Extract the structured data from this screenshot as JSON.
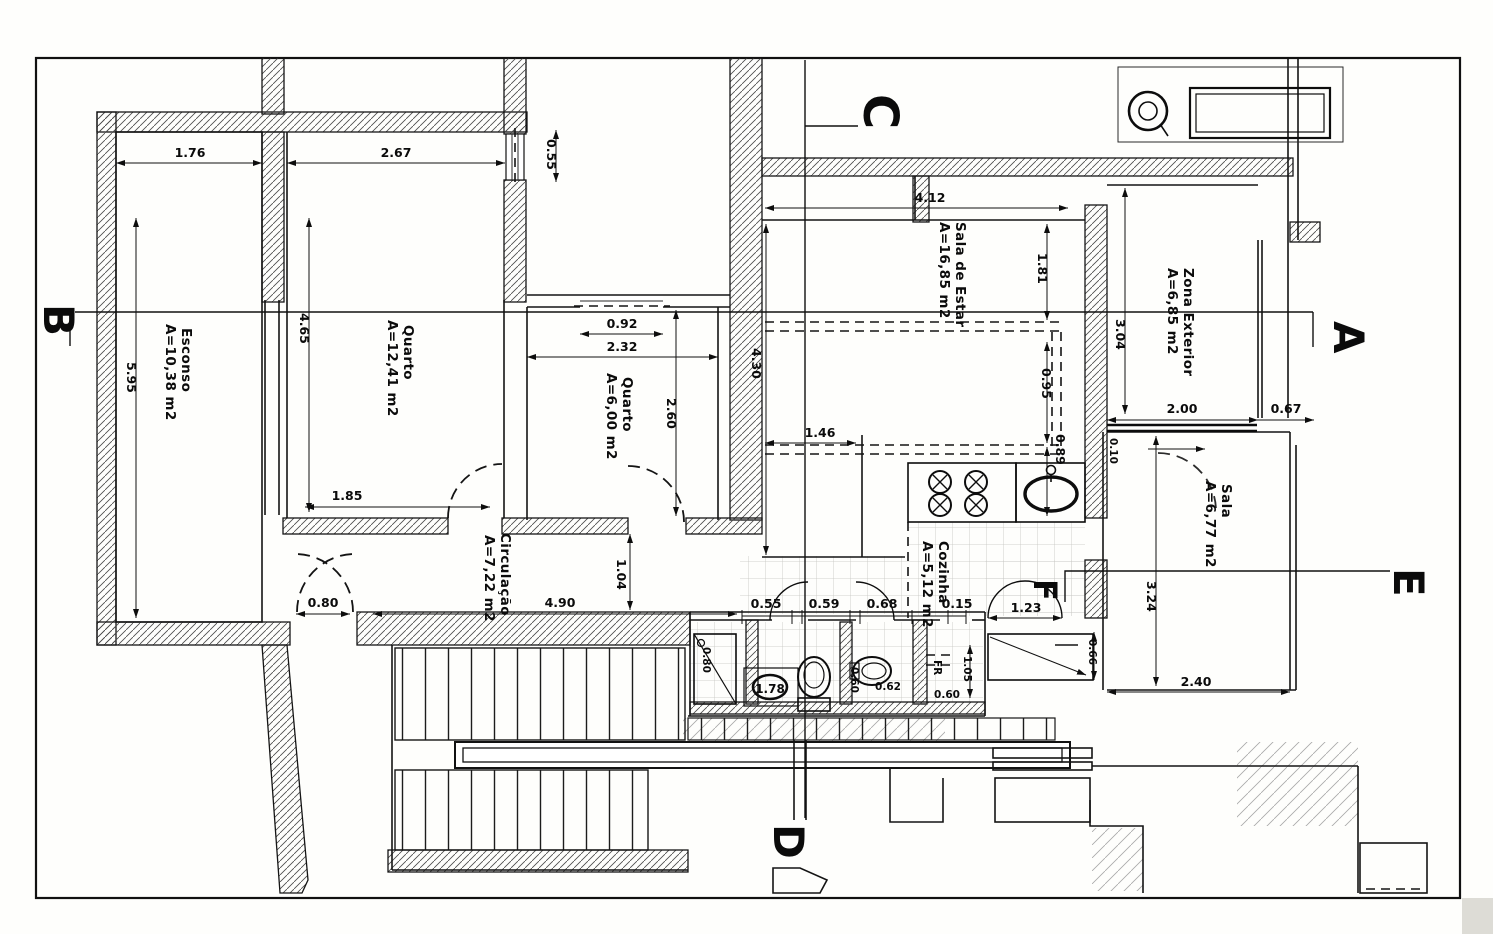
{
  "rooms": [
    {
      "name": "Esconso",
      "area": "A=10,38 m2"
    },
    {
      "name": "Quarto",
      "area": "A=12,41 m2"
    },
    {
      "name": "Quarto",
      "area": "A=6,00 m2"
    },
    {
      "name": "Sala de Estar",
      "area": "A=16,85 m2"
    },
    {
      "name": "Zona Exterior",
      "area": "A=6,85 m2"
    },
    {
      "name": "Sala",
      "area": "A=6,77 m2"
    },
    {
      "name": "Circulação",
      "area": "A=7,22 m2"
    },
    {
      "name": "Cozinha",
      "area": "A=5,12 m2"
    }
  ],
  "markers": {
    "a": "A",
    "b": "B",
    "c": "C",
    "d": "D",
    "e": "E",
    "f": "F"
  },
  "dims": {
    "d176": "1.76",
    "d267": "2.67",
    "d055a": "0.55",
    "d595": "5.95",
    "d465": "4.65",
    "d185": "1.85",
    "d092": "0.92",
    "d232": "2.32",
    "d260": "2.60",
    "d412": "4.12",
    "d181": "1.81",
    "d430": "4.30",
    "d095": "0.95",
    "d089": "0.89",
    "d146": "1.46",
    "d304": "3.04",
    "d200": "2.00",
    "d067": "0.67",
    "d010": "0.10",
    "d324": "3.24",
    "d240": "2.40",
    "d080a": "0.80",
    "d490": "4.90",
    "d104": "1.04",
    "d080b": "0.80",
    "d055b": "0.55",
    "d059": "0.59",
    "d068": "0.68",
    "d015": "0.15",
    "d123": "1.23",
    "d066": "0.66",
    "d105": "1.05",
    "d060a": "0.60",
    "d060b": "0.60",
    "d062": "0.62",
    "d178": "1.78",
    "fr": "FR"
  }
}
